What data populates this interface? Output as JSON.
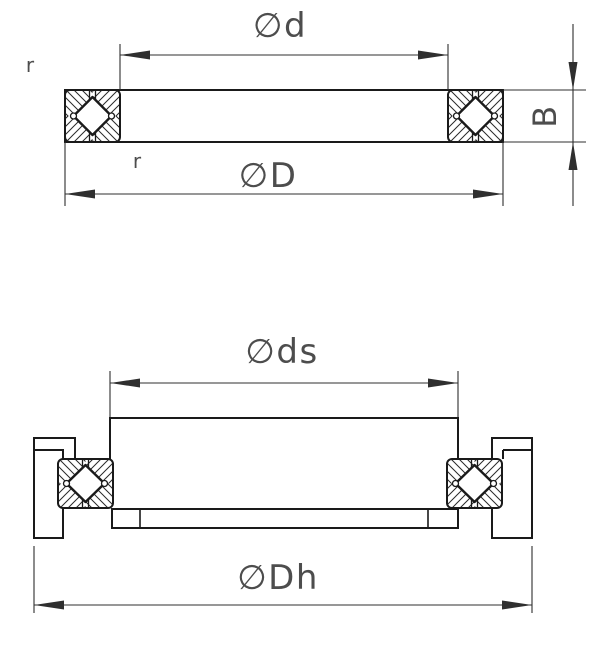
{
  "drawing": {
    "labels": {
      "bore_diameter": "∅d",
      "outer_diameter": "∅D",
      "width": "B",
      "chamfer_top": "r",
      "chamfer_inner": "r",
      "shaft_diameter": "∅ds",
      "housing_diameter": "∅Dh"
    },
    "colors": {
      "line": "#1a1a1a",
      "dimension": "#2f2f2f",
      "hatch": "#2a2a2a",
      "text": "#4d4d4d",
      "background": "#ffffff"
    }
  }
}
